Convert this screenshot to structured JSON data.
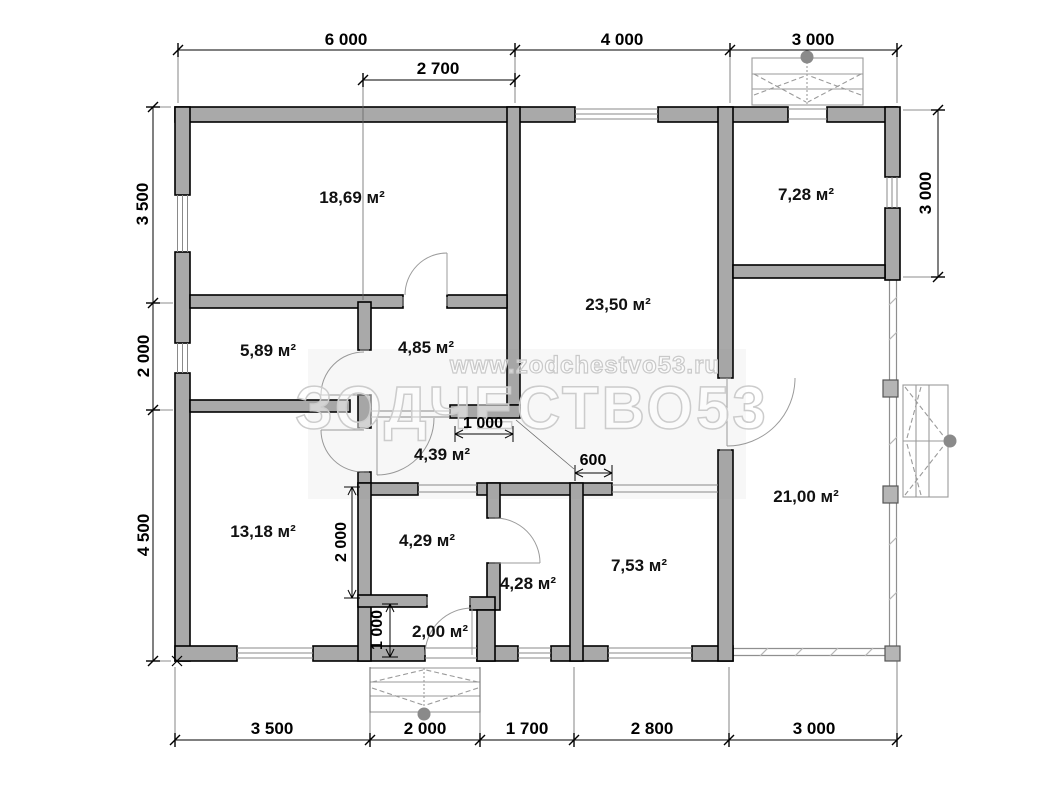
{
  "watermark": {
    "site": "www.zodchestvo53.ru",
    "brand": "ЗОДЧЕСТВО53"
  },
  "rooms": [
    {
      "area": "18,69 м²"
    },
    {
      "area": "23,50 м²"
    },
    {
      "area": "7,28 м²"
    },
    {
      "area": "5,89 м²"
    },
    {
      "area": "4,85 м²"
    },
    {
      "area": "4,39 м²"
    },
    {
      "area": "13,18 м²"
    },
    {
      "area": "4,29 м²"
    },
    {
      "area": "4,28 м²"
    },
    {
      "area": "2,00 м²"
    },
    {
      "area": "7,53 м²"
    },
    {
      "area": "21,00 м²"
    }
  ],
  "dimensions": {
    "top": [
      "6 000",
      "4 000",
      "3 000"
    ],
    "top_secondary": "2 700",
    "left": [
      "3 500",
      "2 000",
      "4 500"
    ],
    "right": "3 000",
    "bottom": [
      "3 500",
      "2 000",
      "1 700",
      "2 800",
      "3 000"
    ],
    "interior": {
      "hall_width": "1 000",
      "wall_stub": "600",
      "room_height": "2 000",
      "entry_depth": "1 000"
    }
  }
}
